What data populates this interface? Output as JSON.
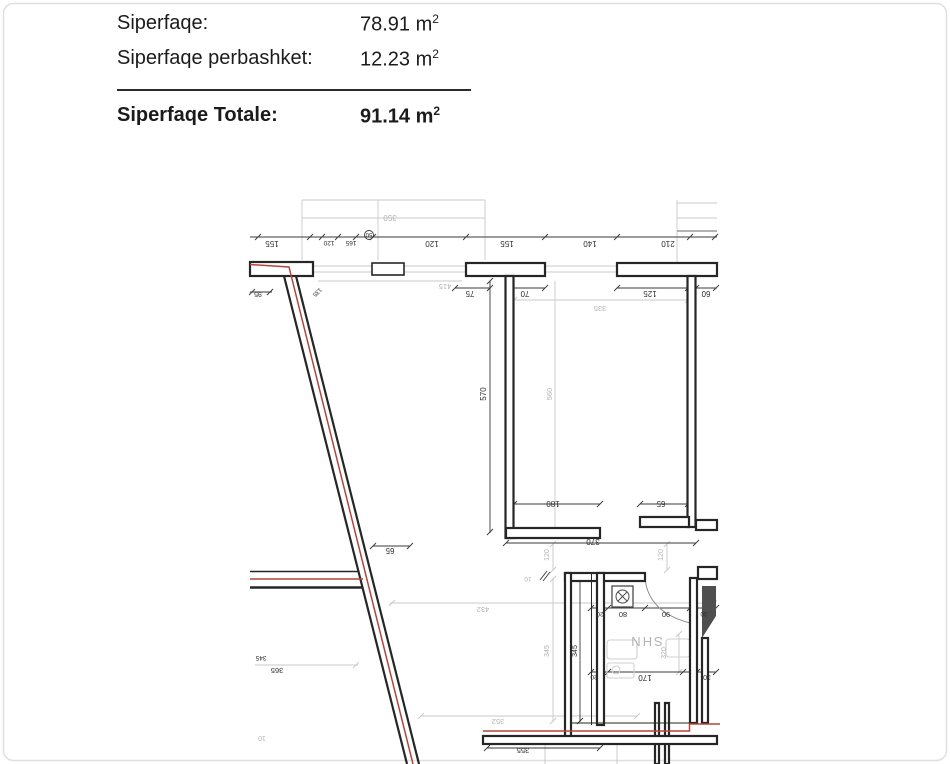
{
  "summary": {
    "rows": [
      {
        "label": "Siperfaqe:",
        "value": "78.91",
        "unit": "m",
        "sup": "2"
      },
      {
        "label": "Siperfaqe perbashket:",
        "value": "12.23",
        "unit": "m",
        "sup": "2"
      }
    ],
    "total": {
      "label": "Siperfaqe Totale:",
      "value": "91.14",
      "unit": "m",
      "sup": "2"
    }
  },
  "plan": {
    "colors": {
      "wall": "#262626",
      "red": "#b5443c",
      "gray_line": "#c9c9c9",
      "dim_line": "#3a3a3a",
      "dark_text": "#2e2e2e",
      "gray_text": "#b3b3b3",
      "shaft_fill": "#4f4f4f"
    },
    "labels": [
      {
        "t": "155",
        "x": 272,
        "y": 241,
        "r": 180,
        "c": "d",
        "s": 8
      },
      {
        "t": "120",
        "x": 329,
        "y": 241,
        "r": 180,
        "c": "d",
        "s": 6.5
      },
      {
        "t": "165",
        "x": 351,
        "y": 241,
        "r": 180,
        "c": "d",
        "s": 6.5
      },
      {
        "t": "50",
        "x": 369,
        "y": 233,
        "r": 180,
        "c": "d",
        "s": 6
      },
      {
        "t": "120",
        "x": 432,
        "y": 241,
        "r": 180,
        "c": "d",
        "s": 8
      },
      {
        "t": "155",
        "x": 507,
        "y": 241,
        "r": 180,
        "c": "d",
        "s": 8
      },
      {
        "t": "140",
        "x": 590,
        "y": 241,
        "r": 180,
        "c": "d",
        "s": 8
      },
      {
        "t": "210",
        "x": 668,
        "y": 241,
        "r": 180,
        "c": "d",
        "s": 8
      },
      {
        "t": "350",
        "x": 390,
        "y": 215,
        "r": 180,
        "c": "g",
        "s": 8
      },
      {
        "t": "95",
        "x": 258,
        "y": 292,
        "r": 180,
        "c": "d",
        "s": 7
      },
      {
        "t": "135",
        "x": 316,
        "y": 291,
        "r": 135,
        "c": "d",
        "s": 6
      },
      {
        "t": "415",
        "x": 445,
        "y": 284,
        "r": 180,
        "c": "g",
        "s": 7.5
      },
      {
        "t": "75",
        "x": 470,
        "y": 291,
        "r": 180,
        "c": "d",
        "s": 8
      },
      {
        "t": "70",
        "x": 525,
        "y": 291,
        "r": 180,
        "c": "d",
        "s": 8
      },
      {
        "t": "125",
        "x": 650,
        "y": 291,
        "r": 180,
        "c": "d",
        "s": 8
      },
      {
        "t": "60",
        "x": 706,
        "y": 291,
        "r": 180,
        "c": "d",
        "s": 8
      },
      {
        "t": "335",
        "x": 600,
        "y": 306,
        "r": 180,
        "c": "g",
        "s": 7.5
      },
      {
        "t": "570",
        "x": 486,
        "y": 394,
        "r": -90,
        "c": "d",
        "s": 8
      },
      {
        "t": "560",
        "x": 552,
        "y": 394,
        "r": -90,
        "c": "g",
        "s": 7.5
      },
      {
        "t": "180",
        "x": 553,
        "y": 501,
        "r": 180,
        "c": "d",
        "s": 8
      },
      {
        "t": "65",
        "x": 661,
        "y": 501,
        "r": 180,
        "c": "d",
        "s": 8
      },
      {
        "t": "370",
        "x": 593,
        "y": 539,
        "r": 180,
        "c": "d",
        "s": 8
      },
      {
        "t": "120",
        "x": 549,
        "y": 555,
        "r": -90,
        "c": "g",
        "s": 7
      },
      {
        "t": "120",
        "x": 663,
        "y": 555,
        "r": -90,
        "c": "g",
        "s": 7
      },
      {
        "t": "10",
        "x": 528,
        "y": 577,
        "r": 180,
        "c": "g",
        "s": 6.5
      },
      {
        "t": "65",
        "x": 390,
        "y": 548,
        "r": 180,
        "c": "d",
        "s": 8
      },
      {
        "t": "432",
        "x": 483,
        "y": 607,
        "r": 180,
        "c": "g",
        "s": 7.5
      },
      {
        "t": "20",
        "x": 600,
        "y": 612,
        "r": 180,
        "c": "d",
        "s": 6.5
      },
      {
        "t": "80",
        "x": 623,
        "y": 612,
        "r": 180,
        "c": "d",
        "s": 7.5
      },
      {
        "t": "90",
        "x": 666,
        "y": 612,
        "r": 180,
        "c": "d",
        "s": 7.5
      },
      {
        "t": "30",
        "x": 704,
        "y": 612,
        "r": 180,
        "c": "d",
        "s": 6.5
      },
      {
        "t": "SHN",
        "x": 646,
        "y": 637,
        "r": 180,
        "c": "g",
        "s": 13
      },
      {
        "t": "345",
        "x": 549,
        "y": 651,
        "r": -90,
        "c": "g",
        "s": 7
      },
      {
        "t": "345",
        "x": 577,
        "y": 651,
        "r": -90,
        "c": "d",
        "s": 7
      },
      {
        "t": "320",
        "x": 666,
        "y": 653,
        "r": -90,
        "c": "g",
        "s": 7
      },
      {
        "t": "20",
        "x": 594,
        "y": 675,
        "r": 180,
        "c": "d",
        "s": 6.5
      },
      {
        "t": "170",
        "x": 645,
        "y": 675,
        "r": 180,
        "c": "d",
        "s": 8
      },
      {
        "t": "30",
        "x": 707,
        "y": 675,
        "r": 180,
        "c": "d",
        "s": 7
      },
      {
        "t": "345",
        "x": 261,
        "y": 656,
        "r": 180,
        "c": "d",
        "s": 6.5
      },
      {
        "t": "365",
        "x": 277,
        "y": 668,
        "r": 180,
        "c": "d",
        "s": 7.5
      },
      {
        "t": "352",
        "x": 498,
        "y": 719,
        "r": 180,
        "c": "g",
        "s": 7.5
      },
      {
        "t": "355",
        "x": 523,
        "y": 748,
        "r": 180,
        "c": "d",
        "s": 7.5
      },
      {
        "t": "10",
        "x": 262,
        "y": 736,
        "r": 180,
        "c": "g",
        "s": 7
      }
    ]
  }
}
